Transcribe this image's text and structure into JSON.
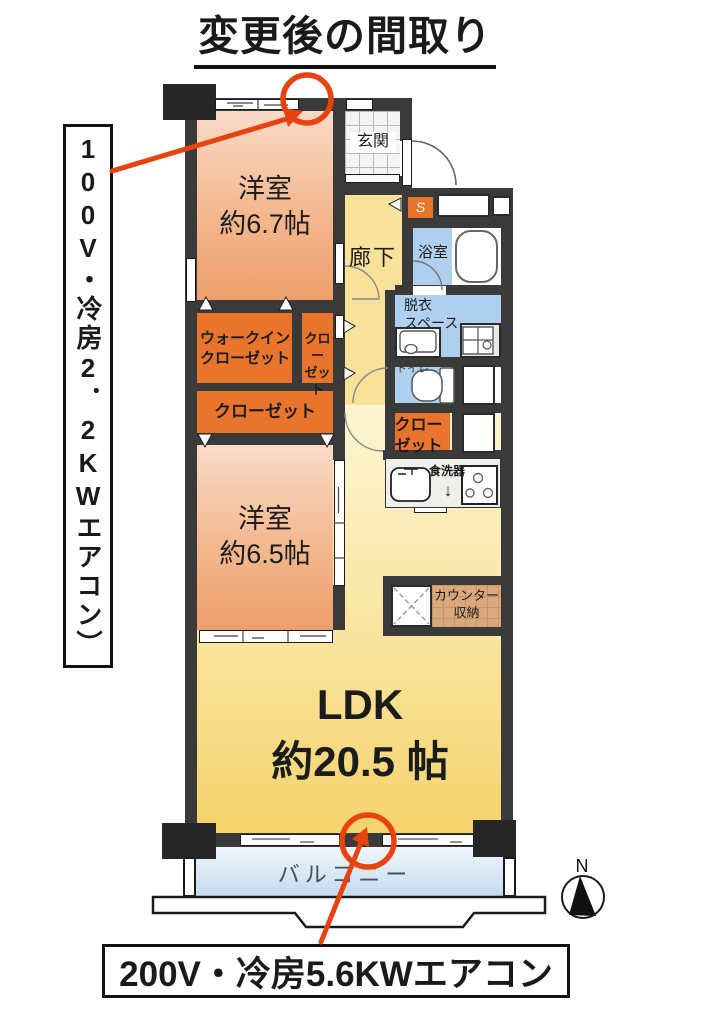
{
  "title": "変更後の間取り",
  "callouts": {
    "left_vertical": "100V・冷房2．2KWエアコン）",
    "bottom": "200V・冷房5.6KWエアコン"
  },
  "compass": {
    "label": "N"
  },
  "rooms": {
    "bedroom1": "洋室\n約6.7帖",
    "bedroom2": "洋室\n約6.5帖",
    "ldk": "LDK\n約20.5 帖",
    "entrance": "玄関",
    "hallway": "廊下",
    "bathroom": "浴室",
    "dressing": "脱衣\nスペース",
    "toilet": "トイレ",
    "walk_in_closet": "ウォークイン\nクローゼット",
    "closet_small": "クロー\nゼット",
    "closet_wide": "クローゼット",
    "closet_right": "クロー\nゼット",
    "shoe_box": "S",
    "dishwasher": "食洗器",
    "dishwasher_arrow": "↓",
    "counter_storage": "カウンター\n収納",
    "balcony": "バルコニー"
  },
  "colors": {
    "accent_red": "#e8430f",
    "wall": "#3a3a3a",
    "closet_orange": "#e8752b",
    "wet_area_blue": "#aecfee",
    "bedroom_salmon": "#ee9e6c",
    "ldk_yellow": "#f5d36c",
    "hallway_yellow": "#f8e198",
    "counter_tan": "#d9a87d"
  }
}
